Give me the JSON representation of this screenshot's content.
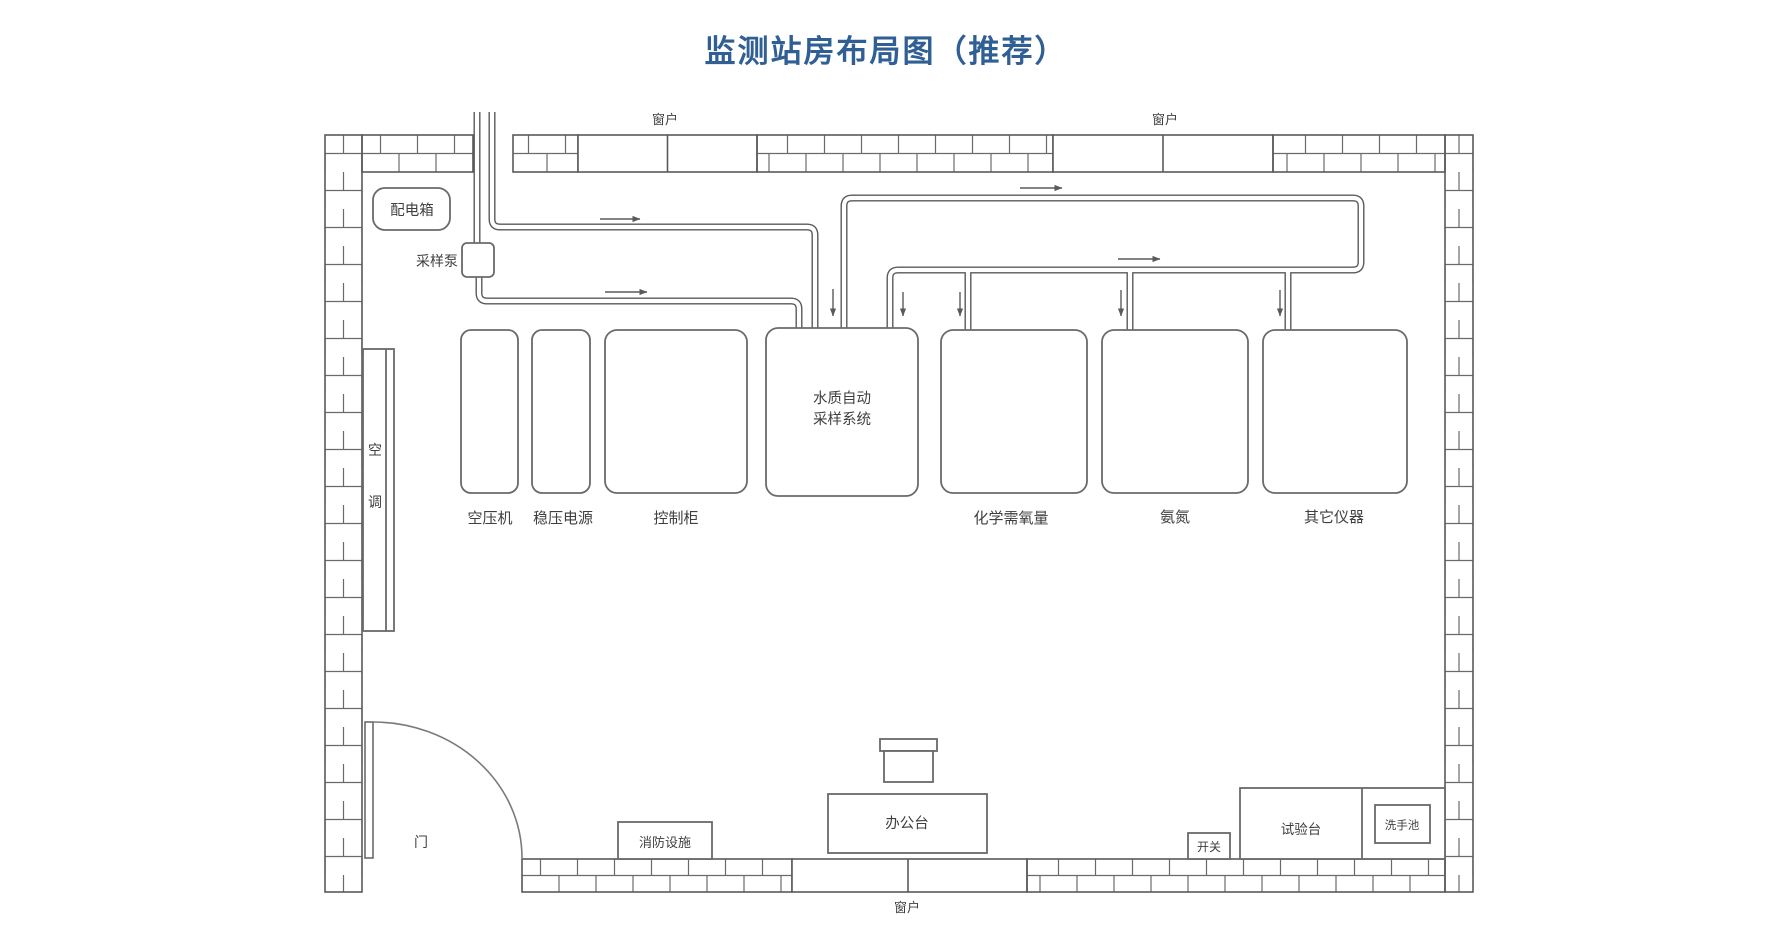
{
  "title": "监测站房布局图（推荐）",
  "colors": {
    "title_blue": "#2f5f93",
    "line_gray": "#5a5a5a",
    "text_gray": "#3f3f3f"
  },
  "labels": {
    "window": "窗户",
    "door": "门",
    "distribution_box": "配电箱",
    "sampling_pump": "采样泵",
    "air_conditioner_char1": "空",
    "air_conditioner_char2": "调",
    "air_compressor": "空压机",
    "voltage_regulator": "稳压电源",
    "control_cabinet": "控制柜",
    "water_auto_sampler_line1": "水质自动",
    "water_auto_sampler_line2": "采样系统",
    "cod_analyzer": "化学需氧量",
    "ammonia_analyzer": "氨氮",
    "other_instruments": "其它仪器",
    "fire_equipment": "消防设施",
    "office_desk": "办公台",
    "switch": "开关",
    "test_bench": "试验台",
    "wash_sink": "洗手池"
  }
}
